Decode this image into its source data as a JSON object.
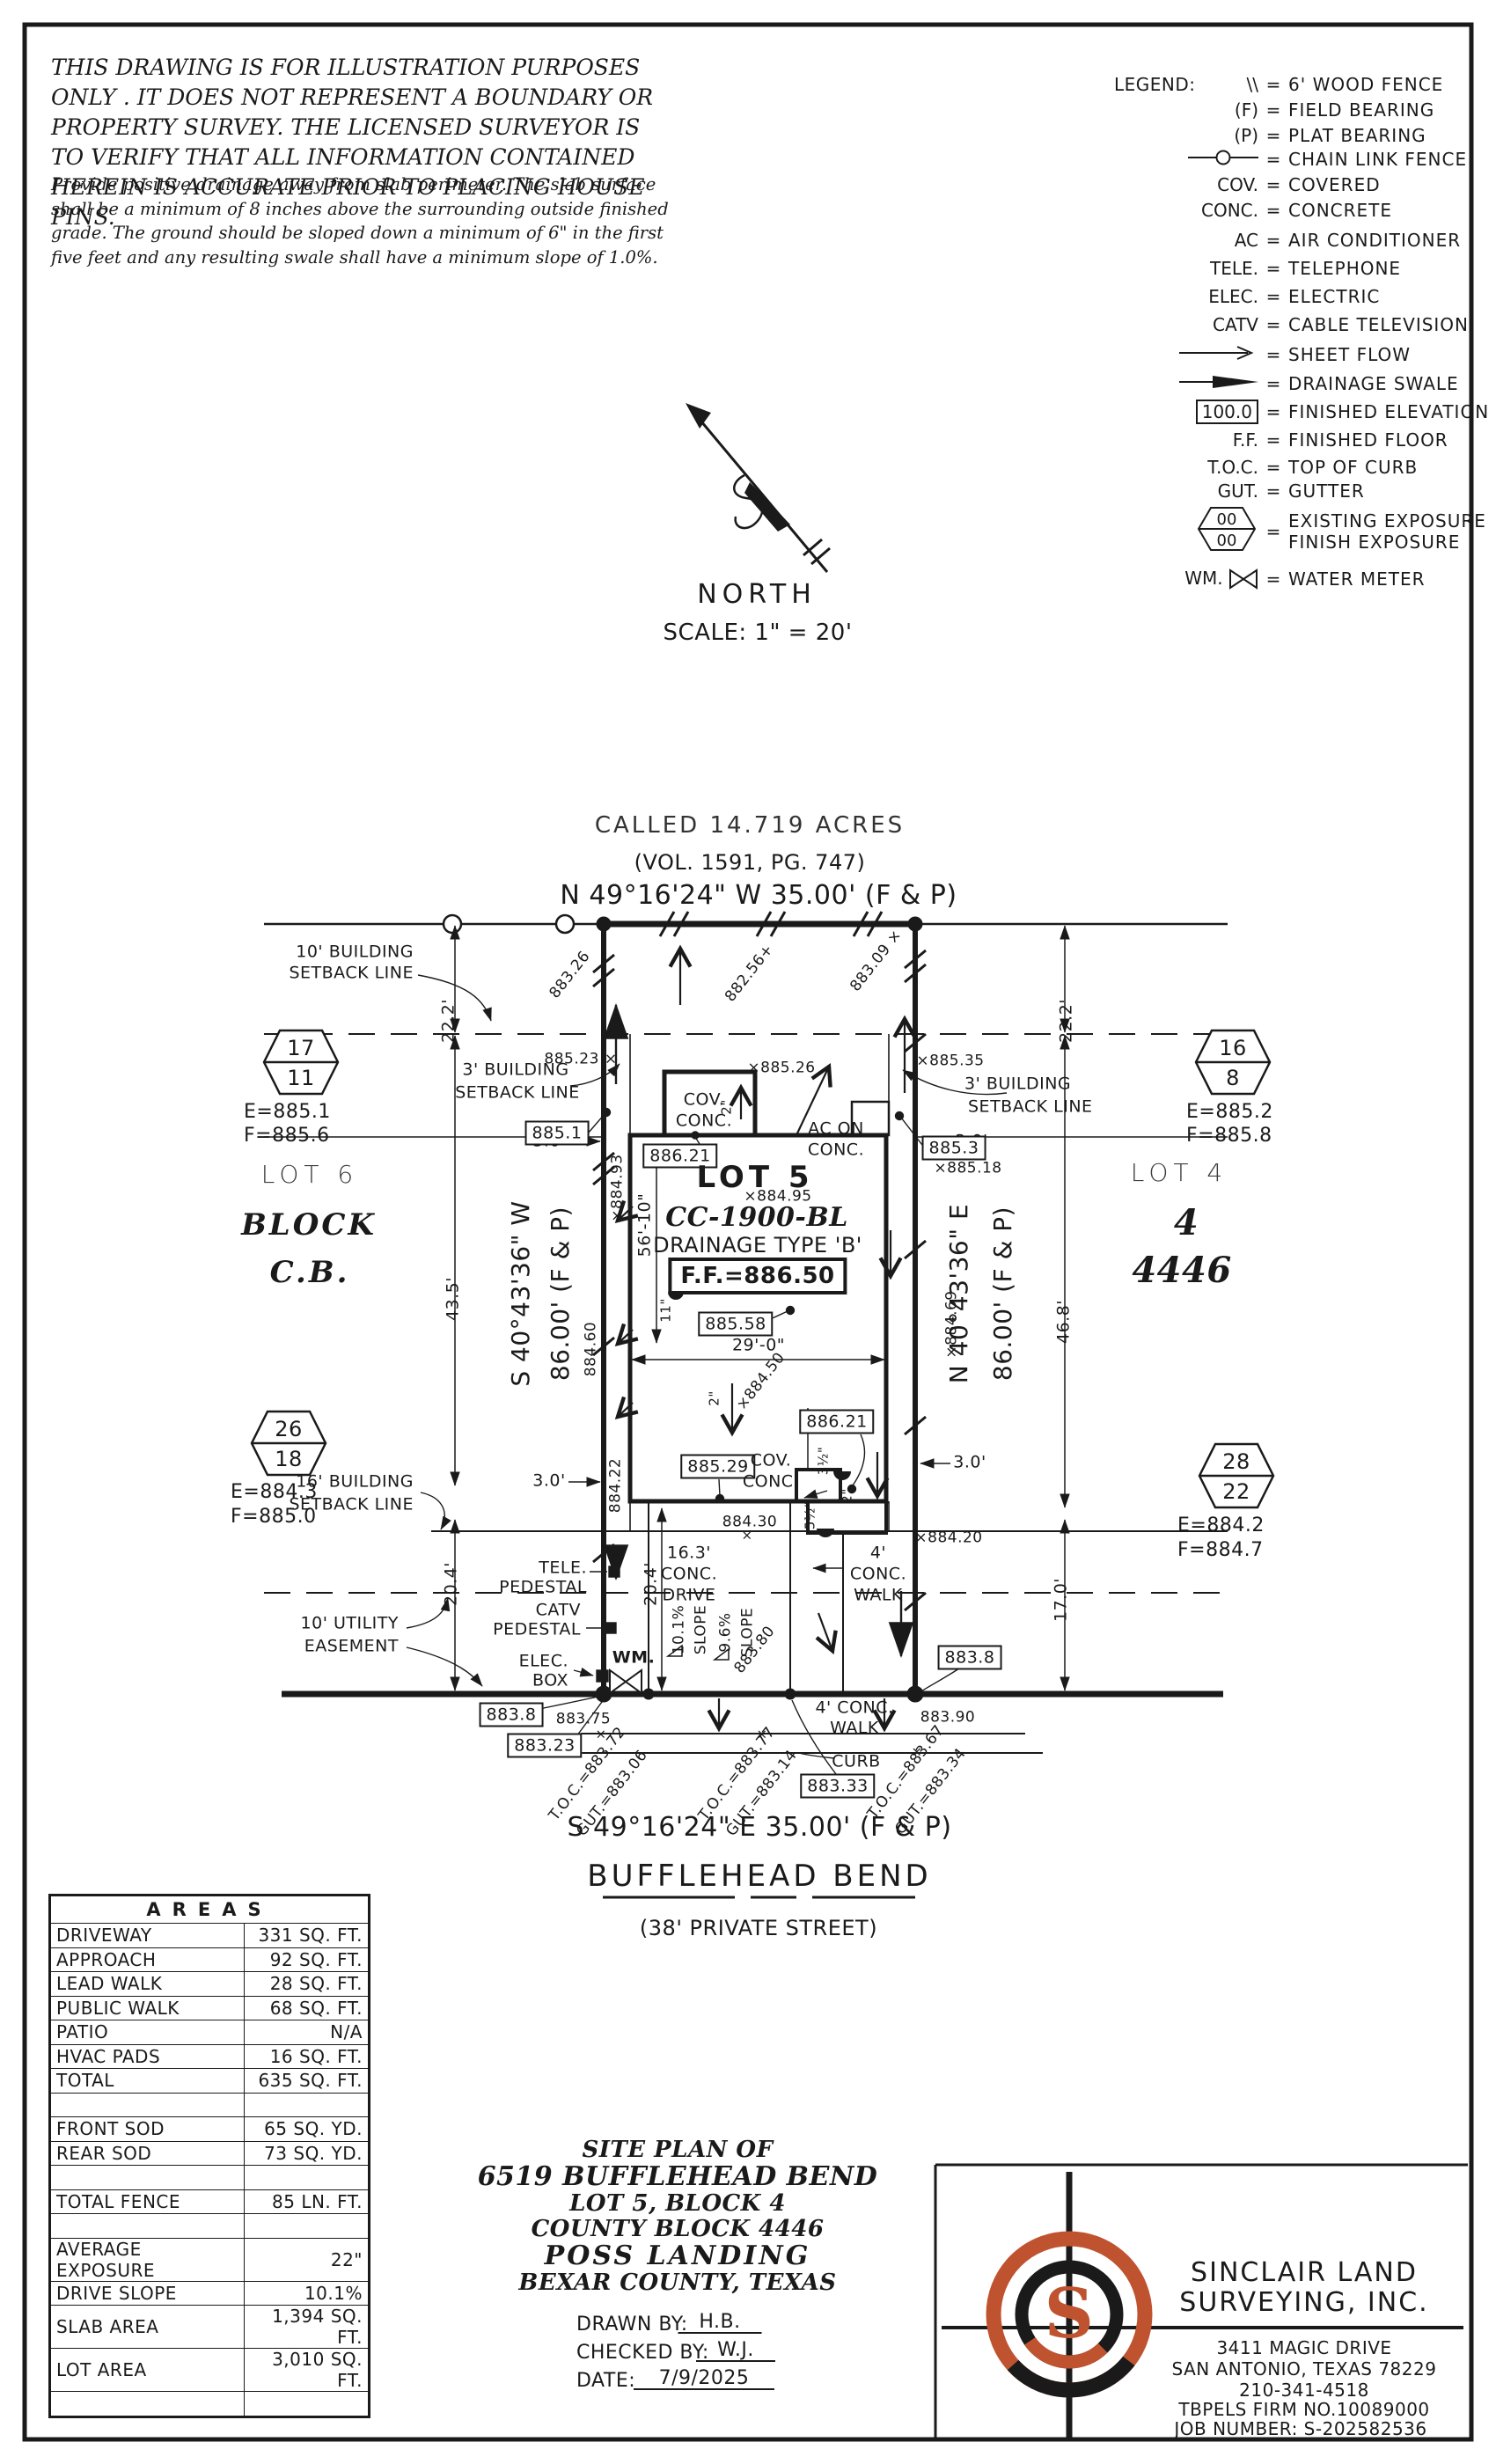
{
  "colors": {
    "accent_orange": "#c0532f",
    "line_black": "#1a1a1a"
  },
  "disclaimer": {
    "para1": "THIS DRAWING IS FOR ILLUSTRATION PURPOSES ONLY . IT DOES NOT REPRESENT A BOUNDARY OR PROPERTY SURVEY. THE LICENSED SURVEYOR IS TO VERIFY THAT ALL INFORMATION CONTAINED HEREIN IS ACCURATE PRIOR TO PLACING HOUSE PINS.",
    "para2": "Provide positive drainage away from slab perimeter. The slab surface shall be a minimum of 8 inches above the surrounding outside finished grade. The ground should be sloped down a minimum of 6\" in the first five feet and any resulting swale shall have a minimum slope of 1.0%."
  },
  "legend": {
    "title": "LEGEND:",
    "eq": "=",
    "wood_sym": "\\\\",
    "wood": "6' WOOD FENCE",
    "f_sym": "(F)",
    "f": "FIELD BEARING",
    "p_sym": "(P)",
    "p": "PLAT BEARING",
    "chain": "CHAIN LINK FENCE",
    "cov_sym": "COV.",
    "cov": "COVERED",
    "conc_sym": "CONC.",
    "conc": "CONCRETE",
    "ac_sym": "AC",
    "ac": "AIR CONDITIONER",
    "tele_sym": "TELE.",
    "tele": "TELEPHONE",
    "elec_sym": "ELEC.",
    "elec": "ELECTRIC",
    "catv_sym": "CATV",
    "catv": "CABLE TELEVISION",
    "sheet": "SHEET FLOW",
    "swale": "DRAINAGE SWALE",
    "fe_val": "100.0",
    "fe": "FINISHED ELEVATION",
    "ff_sym": "F.F.",
    "ff": "FINISHED FLOOR",
    "toc_sym": "T.O.C.",
    "toc": "TOP OF CURB",
    "gut_sym": "GUT.",
    "gut": "GUTTER",
    "hex_top": "00",
    "hex_bottom": "00",
    "exist": "EXISTING EXPOSURE",
    "finish": "FINISH EXPOSURE",
    "wm_sym": "WM.",
    "wm": "WATER METER"
  },
  "north": {
    "label": "NORTH",
    "scale": "SCALE:  1\" = 20'"
  },
  "rear": {
    "called": "CALLED 14.719 ACRES",
    "vol": "(VOL. 1591, PG. 747)",
    "bearing": "N 49°16'24\" W  35.00'  (F & P)"
  },
  "left_side": {
    "bearing": "S 40°43'36\" W",
    "dist": "86.00' (F & P)"
  },
  "right_side": {
    "bearing": "N 40°43'36\" E",
    "dist": "86.00' (F & P)"
  },
  "street": {
    "bearing": "S 49°16'24\" E  35.00'  (F & P)",
    "name": "BUFFLEHEAD BEND",
    "type": "(38' PRIVATE STREET)"
  },
  "lot": {
    "name": "LOT 5",
    "plan_no": "CC-1900-BL",
    "drainage": "DRAINAGE TYPE 'B'",
    "ff": "F.F.=886.50"
  },
  "neighbors": {
    "lot6": "LOT 6",
    "block_word": "BLOCK",
    "block_cb": "C.B.",
    "lot4": "LOT 4",
    "block4": "4",
    "cb4446": "4446"
  },
  "hex": {
    "h1t": "17",
    "h1b": "11",
    "h1e": "E=885.1",
    "h1f": "F=885.6",
    "h2t": "16",
    "h2b": "8",
    "h2e": "E=885.2",
    "h2f": "F=885.8",
    "h3t": "26",
    "h3b": "18",
    "h3e": "E=884.3",
    "h3f": "F=885.0",
    "h4t": "28",
    "h4b": "22",
    "h4e": "E=884.2",
    "h4f": "F=884.7"
  },
  "setbacks": {
    "s10a": "10' BUILDING",
    "s10b": "SETBACK LINE",
    "s3la": "3' BUILDING",
    "s3lb": "SETBACK LINE",
    "s3ra": "3' BUILDING",
    "s3rb": "SETBACK LINE",
    "s16a": "16' BUILDING",
    "s16b": "SETBACK LINE",
    "uta": "10' UTILITY",
    "utb": "EASEMENT"
  },
  "dims": {
    "d22l": "22.2'",
    "d22r": "22.2'",
    "d435": "43.5'",
    "d468": "46.8'",
    "d204l": "20.4'",
    "d170": "17.0'",
    "d204i": "20.4'",
    "d5610": "56'-10\"",
    "d290": "29'-0\"",
    "d11": "11\"",
    "d30tl": "3.0'",
    "d30tr": "3.0'",
    "d30bl": "3.0'",
    "d30br": "3.0'",
    "d2a": "2\"",
    "d2b": "2\"",
    "d2c": "2\"",
    "d35": "3½\"",
    "d55": "5½\""
  },
  "elev": {
    "e88326": "883.26",
    "e88256": "882.56+",
    "e88309": "883.09 ×",
    "e88523": "885.23 ×",
    "e88526": "×885.26",
    "e88535": "×885.35",
    "e88518": "×885.18",
    "e88495": "×884.95",
    "e88493": "×884.93",
    "e88460": "884.60",
    "e88422": "884.22",
    "e88469": "×884.69",
    "e88450": "×884.50",
    "e88430": "884.30",
    "e88420": "×884.20",
    "e88380": "883.80",
    "e88375": "883.75",
    "e88390": "883.90",
    "toc1": "T.O.C.=883.72",
    "gut1": "GUT.=883.06",
    "toc2": "T.O.C.=883.77",
    "gut2": "GUT.=883.14",
    "toc3": "T.O.C.=883.67",
    "gut3": "GUT.=883.34",
    "x1": "×",
    "x2": "×",
    "x3": "×",
    "x4": "×"
  },
  "boxed": {
    "b8851": "885.1",
    "b8853": "885.3",
    "b88621a": "886.21",
    "b88621b": "886.21",
    "b88558": "885.58",
    "b88529": "885.29",
    "b8838l": "883.8",
    "b88323": "883.23",
    "b88333": "883.33",
    "b8838r": "883.8"
  },
  "features": {
    "cov1a": "COV.",
    "cov1b": "CONC.",
    "ac1": "AC ON",
    "ac2": "CONC.",
    "cov2a": "COV.",
    "cov2b": "CONC.",
    "drv1": "16.3'",
    "drv2": "CONC.",
    "drv3": "DRIVE",
    "wk1": "4'",
    "wk2": "CONC.",
    "wk3": "WALK",
    "wkb1": "4' CONC.",
    "wkb2": "WALK",
    "slope1": "10.1%",
    "slopew1": "SLOPE",
    "slope2": "9.6%",
    "slopew2": "SLOPE",
    "curb": "CURB",
    "tele1": "TELE.",
    "tele2": "PEDESTAL",
    "catv1": "CATV",
    "catv2": "PEDESTAL",
    "elec1": "ELEC.",
    "elec2": "BOX",
    "wm": "WM."
  },
  "areas": {
    "title": "AREAS",
    "rows": [
      [
        "DRIVEWAY",
        "331 SQ. FT."
      ],
      [
        "APPROACH",
        "92 SQ. FT."
      ],
      [
        "LEAD WALK",
        "28 SQ. FT."
      ],
      [
        "PUBLIC WALK",
        "68 SQ. FT."
      ],
      [
        "PATIO",
        "N/A"
      ],
      [
        "HVAC PADS",
        "16 SQ. FT."
      ],
      [
        "TOTAL",
        "635 SQ. FT."
      ],
      [
        "",
        ""
      ],
      [
        "FRONT SOD",
        "65 SQ. YD."
      ],
      [
        "REAR SOD",
        "73 SQ. YD."
      ],
      [
        "",
        ""
      ],
      [
        "TOTAL FENCE",
        "85 LN. FT."
      ],
      [
        "",
        ""
      ],
      [
        "AVERAGE EXPOSURE",
        "22\""
      ],
      [
        "DRIVE SLOPE",
        "10.1%"
      ],
      [
        "SLAB AREA",
        "1,394 SQ. FT."
      ],
      [
        "LOT AREA",
        "3,010 SQ. FT."
      ],
      [
        "",
        ""
      ]
    ]
  },
  "title_block": {
    "l1": "SITE PLAN OF",
    "l2": "6519 BUFFLEHEAD BEND",
    "l3": "LOT 5, BLOCK 4",
    "l4": "COUNTY BLOCK 4446",
    "l5": "POSS LANDING",
    "l6": "BEXAR COUNTY, TEXAS",
    "drawn_label": "DRAWN BY:",
    "drawn": "H.B.",
    "checked_label": "CHECKED BY:",
    "checked": "W.J.",
    "date_label": "DATE:",
    "date": "7/9/2025"
  },
  "firm": {
    "logo_letter": "S",
    "name1": "SINCLAIR LAND",
    "name2": "SURVEYING, INC.",
    "addr1": "3411 MAGIC DRIVE",
    "addr2": "SAN ANTONIO, TEXAS 78229",
    "phone": "210-341-4518",
    "firm_no": "TBPELS FIRM NO.10089000",
    "job": "JOB NUMBER:  S-202582536"
  }
}
